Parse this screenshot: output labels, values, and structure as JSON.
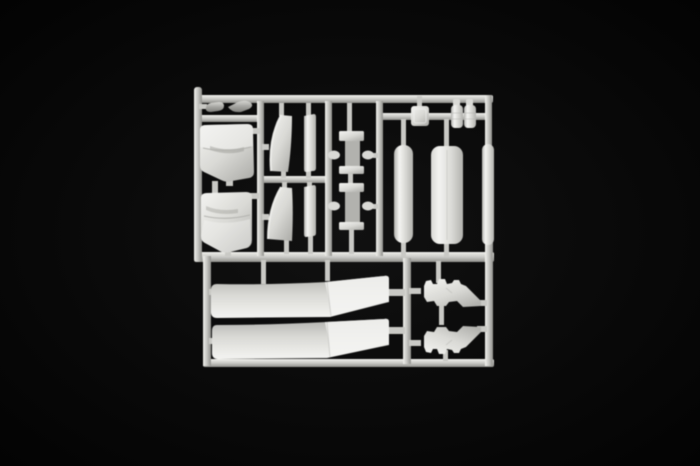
{
  "scene": {
    "type": "photograph",
    "description": "Injection-molded plastic model kit sprue (parts tree) in light grey styrene, photographed on a black background",
    "background": "black studio backdrop",
    "object": "model-kit-sprue"
  },
  "palette": {
    "bg": "#020202",
    "bg_center": "#111111",
    "runner": "#c9c9c5",
    "runner_hi": "#f0f0ec",
    "runner_dim": "#90908c",
    "part": "#d9d9d5",
    "part_hi": "#f4f4f1",
    "part_dim": "#b2b2ae",
    "part_shadow": "#80807c",
    "pod": "#a5a5a1",
    "pod_hi": "#d6d6d2"
  },
  "parts": [
    {
      "id": "pod-a",
      "label": "small pod part"
    },
    {
      "id": "pod-b",
      "label": "small pod part"
    },
    {
      "id": "panel-upper",
      "label": "curved body panel with fold line"
    },
    {
      "id": "panel-lower",
      "label": "curved body panel with fold line"
    },
    {
      "id": "deflector-upper",
      "label": "curved deflector blade"
    },
    {
      "id": "deflector-lower",
      "label": "curved deflector blade"
    },
    {
      "id": "strip-upper",
      "label": "flat strip part"
    },
    {
      "id": "strip-lower",
      "label": "flat strip part"
    },
    {
      "id": "step-upper",
      "label": "flanged step panel with side pins"
    },
    {
      "id": "step-lower",
      "label": "flanged step panel with side pins"
    },
    {
      "id": "intake-box",
      "label": "small square box part"
    },
    {
      "id": "canister-a",
      "label": "small ribbed canister"
    },
    {
      "id": "canister-b",
      "label": "small ribbed canister"
    },
    {
      "id": "tank-slim-left",
      "label": "slim cylindrical tank"
    },
    {
      "id": "tank-large",
      "label": "large cylindrical tank"
    },
    {
      "id": "tank-slim-right",
      "label": "slim cylindrical tank"
    },
    {
      "id": "side-skirt-upper",
      "label": "long bent side-skirt fairing"
    },
    {
      "id": "side-skirt-lower",
      "label": "long bent side-skirt fairing"
    },
    {
      "id": "bracket-upper",
      "label": "toothed wedge bracket"
    },
    {
      "id": "bracket-lower",
      "label": "toothed wedge bracket (mirrored)"
    }
  ]
}
